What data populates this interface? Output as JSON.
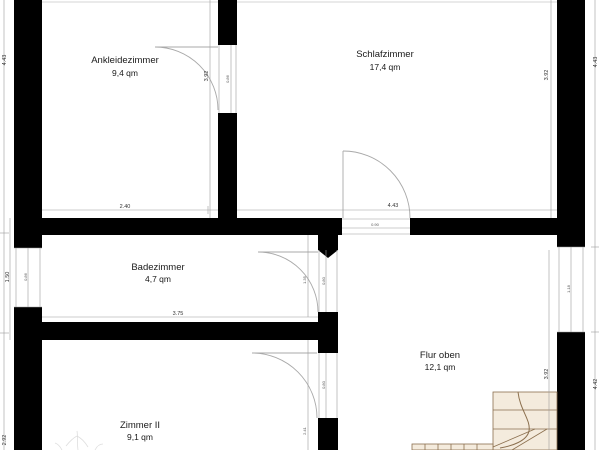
{
  "rooms": [
    {
      "id": "ankleidezimmer",
      "name": "Ankleidezimmer",
      "area": "9,4 qm"
    },
    {
      "id": "schlafzimmer",
      "name": "Schlafzimmer",
      "area": "17,4 qm"
    },
    {
      "id": "badezimmer",
      "name": "Badezimmer",
      "area": "4,7 qm"
    },
    {
      "id": "flur-oben",
      "name": "Flur oben",
      "area": "12,1 qm"
    },
    {
      "id": "zimmer-2",
      "name": "Zimmer II",
      "area": "9,1 qm"
    }
  ],
  "dims": {
    "left_outer_top": "4.43",
    "left_inner_mid": "1.50",
    "left_window": "0.86",
    "left_outer_bottom": "2.92",
    "top_room_height": "3.92",
    "top_door_width": "0.86",
    "ankleide_width": "2.40",
    "schlafzimmer_width": "4.43",
    "right_inner_top": "3.92",
    "right_outer_top": "4.43",
    "right_window": "1.18",
    "right_inner_bottom": "3.92",
    "right_outer_bottom": "4.42",
    "flur_door_width": "0.90",
    "badezimmer_width": "3.75",
    "bad_door_offset": "1.35",
    "bad_door_width": "0.80",
    "zimmer2_door_width": "0.80",
    "zimmer2_door_offset": "2.41"
  },
  "colors": {
    "bg": "#ffffff",
    "wall": "#000000",
    "dim": "#9b9b9b",
    "text": "#1a1a1a",
    "stairs_fill": "#f4ebdd",
    "stairs_stroke": "#8b6f4e"
  }
}
